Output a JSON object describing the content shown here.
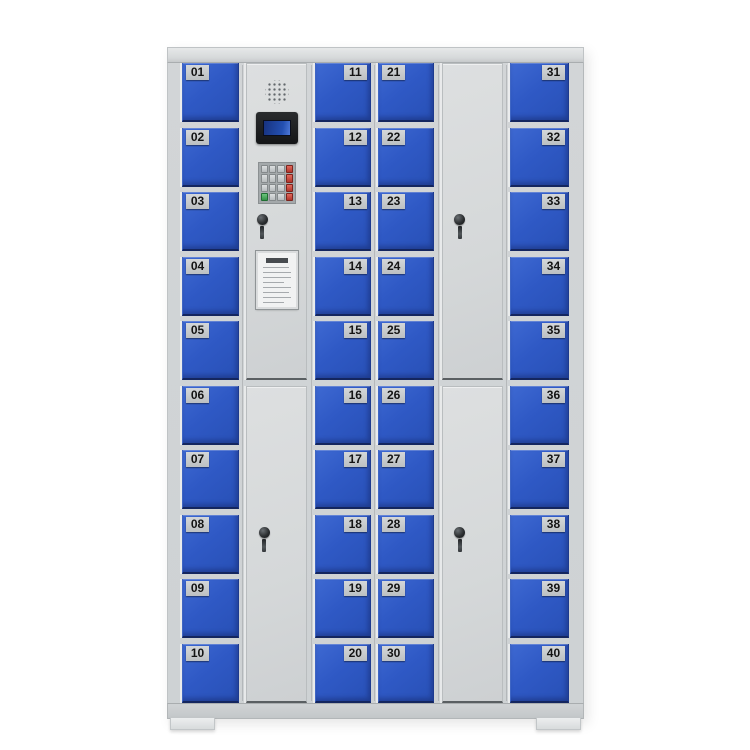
{
  "colors": {
    "background": "#ffffff",
    "cabinet_frame_grey": "#d2d5d7",
    "door_blue": "#2f59c5",
    "door_edge_navy": "#14265f",
    "number_plate_grey": "#c9ccce",
    "number_text_black": "#141414",
    "lcd_screen_blue": "#2450b2",
    "keypad_red_key": "#b2352b",
    "keypad_green_key": "#359348"
  },
  "locker": {
    "door_numbers": {
      "column_1": [
        "01",
        "02",
        "03",
        "04",
        "05",
        "06",
        "07",
        "08",
        "09",
        "10"
      ],
      "column_3": [
        "11",
        "12",
        "13",
        "14",
        "15",
        "16",
        "17",
        "18",
        "19",
        "20"
      ],
      "column_4": [
        "21",
        "22",
        "23",
        "24",
        "25",
        "26",
        "27",
        "28",
        "29",
        "30"
      ],
      "column_6": [
        "31",
        "32",
        "33",
        "34",
        "35",
        "36",
        "37",
        "38",
        "39",
        "40"
      ]
    },
    "control_panel": {
      "component_icons": [
        "speaker-grille-icon",
        "lcd-display",
        "numeric-keypad",
        "key-lock-icon",
        "instruction-card"
      ]
    }
  }
}
